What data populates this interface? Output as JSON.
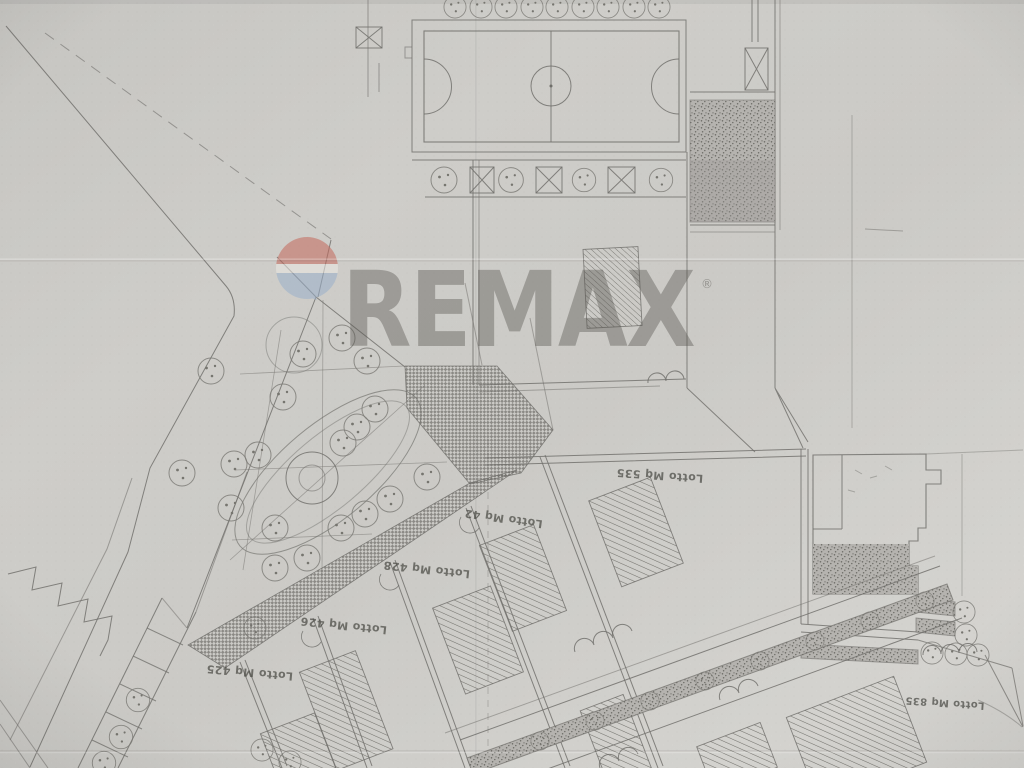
{
  "watermark": {
    "brand_text": "REMAX",
    "registered_mark": "®",
    "balloon_icon": "remax-balloon-icon",
    "colors": {
      "wordmark_gray": "#55534e",
      "balloon_red": "#c4695c",
      "balloon_white": "#ece9e4",
      "balloon_blue": "#9bb0ca"
    }
  },
  "plan": {
    "paper_color": "#cdccc8",
    "ink_color": "#6f6e6a",
    "lot_labels": [
      {
        "label": "Lotto Mq 535"
      },
      {
        "label": "Lotto Mq 42"
      },
      {
        "label": "Lotto Mq 428"
      },
      {
        "label": "Lotto Mq 426"
      },
      {
        "label": "Lotto Mq 425"
      },
      {
        "label": "Lotto Mq 835"
      }
    ]
  }
}
